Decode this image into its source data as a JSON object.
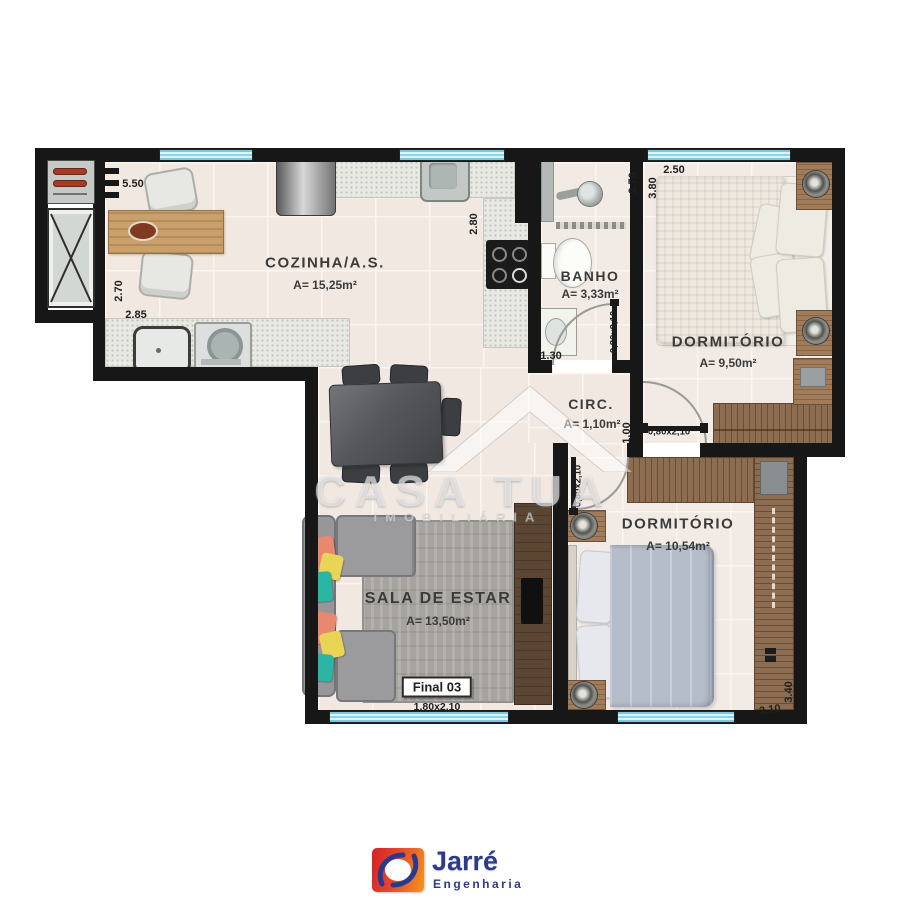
{
  "plan": {
    "unit_label": "Final 03",
    "rooms": {
      "cozinha": {
        "name": "COZINHA/A.S.",
        "area": "A= 15,25m²"
      },
      "banho": {
        "name": "BANHO",
        "area": "A= 3,33m²"
      },
      "dormitorio1": {
        "name": "DORMITÓRIO",
        "area": "A= 9,50m²"
      },
      "circ": {
        "name": "CIRC.",
        "area": "A= 1,10m²"
      },
      "dormitorio2": {
        "name": "DORMITÓRIO",
        "area": "A= 10,54m²"
      },
      "sala": {
        "name": "SALA DE ESTAR",
        "area": "A= 13,50m²"
      }
    },
    "dimensions": {
      "kitchen_top": "5.50",
      "kitchen_left_upper": "2.70",
      "kitchen_left_lower": "2.85",
      "kitchen_right": "2.80",
      "banho_bottom": "1.30",
      "banho_right_upper": "2.70",
      "dorm1_left": "3.80",
      "dorm1_top": "2.50",
      "circ_right": "1.00",
      "dorm2_right": "3.40",
      "dorm2_bottom": "3.10"
    },
    "doors": {
      "banho": "0,80x2,10",
      "dorm1": "0,80x2,10",
      "dorm2": "0,80x2,10"
    },
    "windows": {
      "sala": "1,80x2,10"
    }
  },
  "watermark": {
    "title": "CASA TUA",
    "subtitle": "IMOBILIÁRIA"
  },
  "logo": {
    "name": "Jarré",
    "tagline": "Engenharia"
  },
  "colors": {
    "wall": "#171717",
    "window": "#aadeee",
    "wood": "#8d6d52",
    "logo_red": "#d61f26",
    "logo_orange": "#f7941d",
    "logo_blue": "#2d3a8c"
  }
}
